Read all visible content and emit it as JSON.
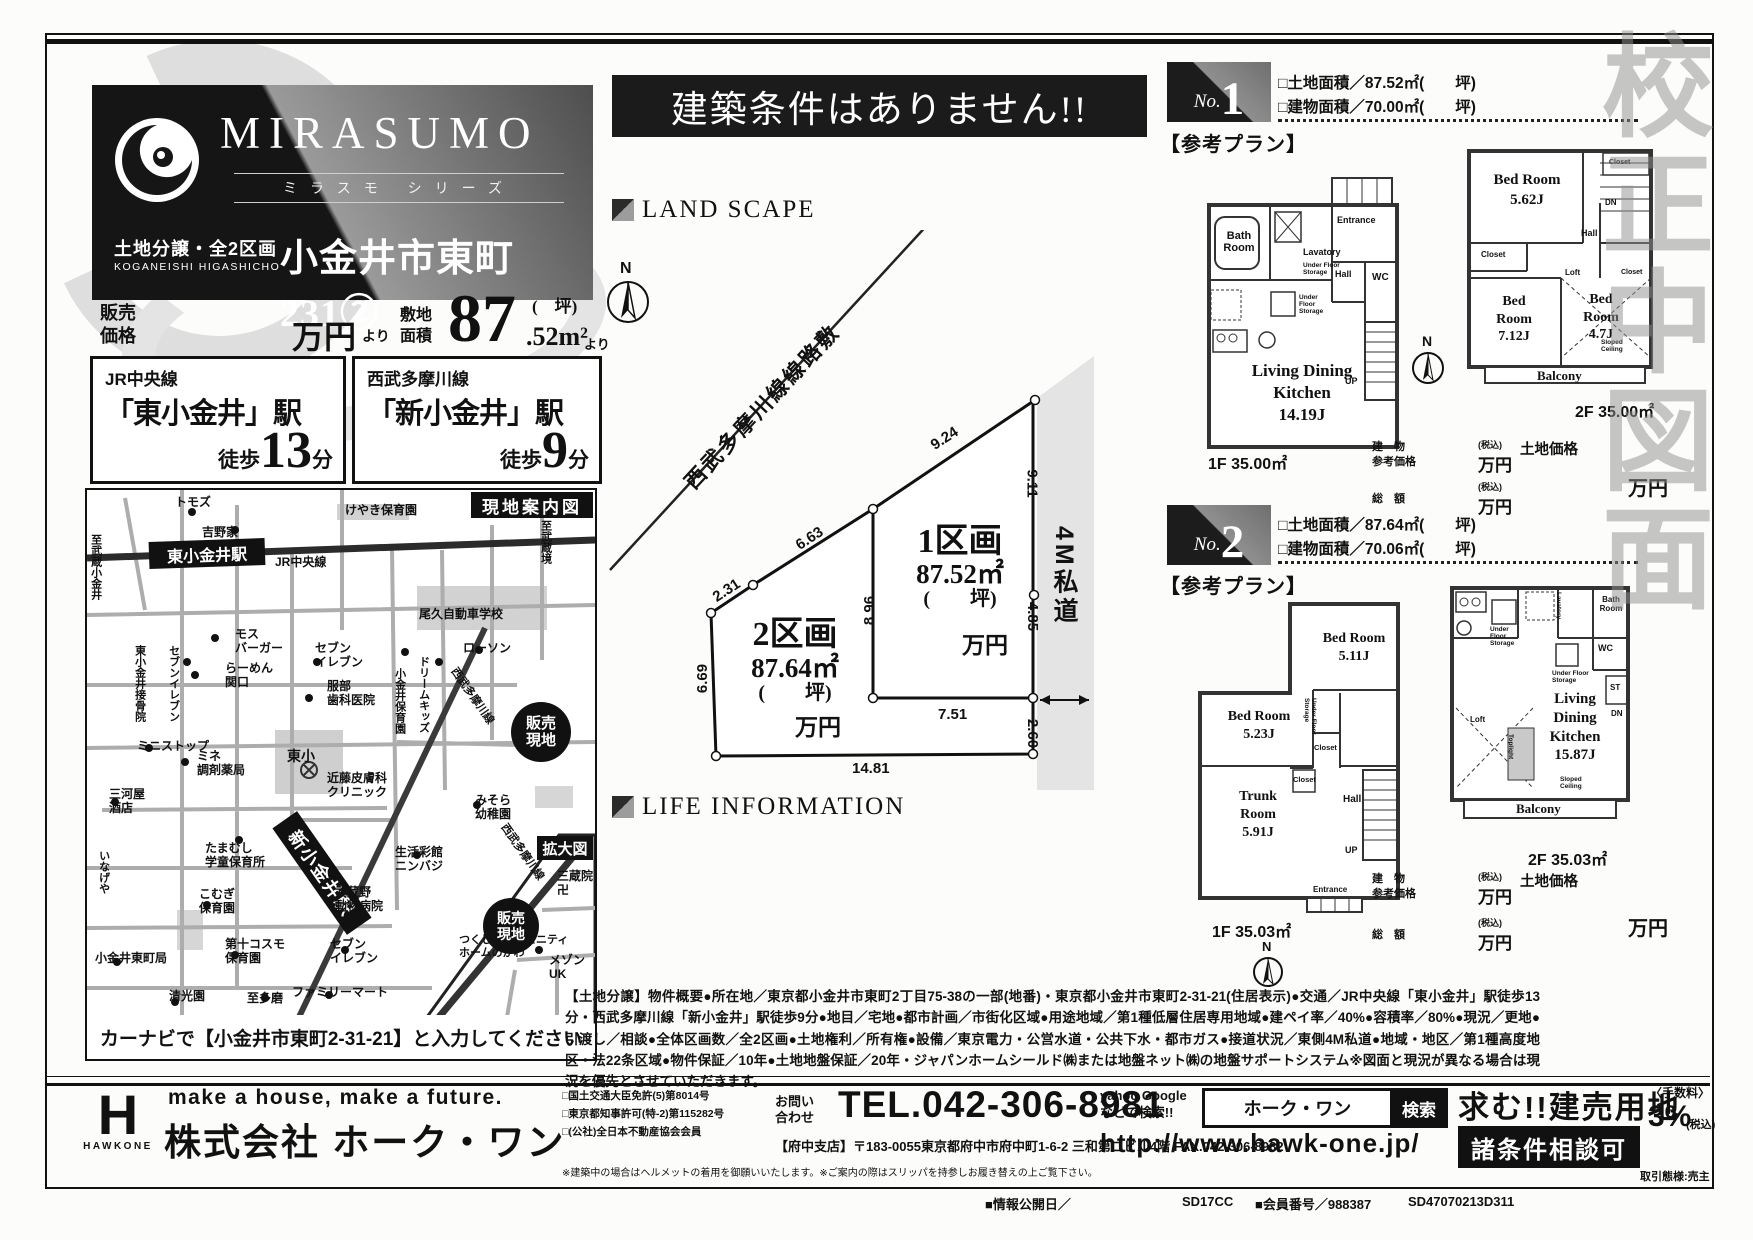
{
  "colors": {
    "ink": "#111111",
    "panel_dark": "#151515",
    "panel_gray": "#9a9a9a",
    "road_gray": "#adadad"
  },
  "watermark": "校正中図面",
  "brand": {
    "mirasumo": "MIRASUMO",
    "series": "ミラスモ シリーズ",
    "lot": "土地分譲・全2区画",
    "romaji": "KOGANEISHI HIGASHICHO",
    "name": "小金井市東町231②"
  },
  "price": {
    "label": "販売\n価格",
    "man": "万円",
    "yori": "より",
    "area_label": "敷地\n面積",
    "big": "87",
    "tsubo": "(　坪)",
    "dec": ".52m²",
    "yori2": "より"
  },
  "access": [
    {
      "line": "JR中央線",
      "station": "「東小金井」駅",
      "walk": "徒歩",
      "min": "13",
      "unit": "分"
    },
    {
      "line": "西武多摩川線",
      "station": "「新小金井」駅",
      "walk": "徒歩",
      "min": "9",
      "unit": "分"
    }
  ],
  "banner": "建築条件はありません!!",
  "sections": {
    "landscape": "LAND SCAPE",
    "lifeinfo": "LIFE INFORMATION"
  },
  "map": {
    "title": "現地案内図",
    "inset": "拡大図",
    "navi": "カーナビで【小金井市東町2-31-21】と入力してください",
    "labels": {
      "tomozu": "トモズ",
      "yoshinoya": "吉野家",
      "to_musashikoganei": "至武蔵小金井",
      "higashi_sta": "東小金井駅",
      "jr": "JR中央線",
      "keyaki": "けやき保育園",
      "to_musashisakai": "至武蔵境",
      "oku": "尾久自動車学校",
      "mos": "モス\nバーガー",
      "seven1": "セブンイレブン",
      "sekkotsu": "東小金井接骨院",
      "ramen": "らーめん\n関口",
      "seven2": "セブン\nイレブン",
      "hattori": "服部\n歯科医院",
      "koganei_hoiku": "小金井保育園",
      "dream": "ドリームキッズ",
      "lawson": "ローソン",
      "seibu": "西武多摩川線",
      "ministop": "ミニストップ",
      "mine": "ミネ\n調剤薬局",
      "tosho": "東小",
      "kondo": "近藤皮膚科\nクリニック",
      "misora": "みそら\n幼稚園",
      "mikawaya": "三河屋\n酒店",
      "hanbai": "販売\n現地",
      "tamamushi": "たまむし\n学童保育所",
      "seikatsu": "生活彩館\nニンバジ",
      "shin_sta": "新小金井駅",
      "musashino": "武蔵野\n動物病院",
      "inageya": "いなげや",
      "komugi": "こむぎ\n保育園",
      "cosmo": "第十コスモ\n保育園",
      "post": "小金井東町局",
      "seiko": "清光園",
      "tama": "至多磨",
      "family": "ファミリーマート",
      "seven3": "セブン\nイレブン",
      "sanzo": "三蔵院\n卍",
      "tsukushi": "つくし会コミュニティ\nホームのがわ",
      "maison": "メゾン\nUK",
      "hanbai2": "販売\n現地",
      "seibu2": "西武多摩川線"
    }
  },
  "plot": {
    "railway": "西武多摩川線線路敷",
    "north": "N",
    "road": "4M私道",
    "dims": {
      "a": "9.24",
      "b": "6.63",
      "c": "2.31",
      "d": "6.69",
      "e": "8.96",
      "f": "9.11",
      "g": "4.85",
      "h": "7.51",
      "j": "2.60",
      "k": "14.81"
    },
    "lot1": {
      "name": "1区画",
      "area": "87.52㎡",
      "tsubo": "(　　坪)",
      "price": "万円"
    },
    "lot2": {
      "name": "2区画",
      "area": "87.64㎡",
      "tsubo": "(　　坪)",
      "price": "万円"
    }
  },
  "plans": [
    {
      "no": "No.",
      "num": "1",
      "ref": "【参考プラン】",
      "land": "□土地面積／87.52㎡(　　坪)",
      "bldg": "□建物面積／70.00㎡(　　坪)",
      "f1_label": "1F 35.00㎡",
      "f2_label": "2F 35.00㎡",
      "f1rooms": {
        "bath": "Bath\nRoom",
        "lav": "Lavatory",
        "ufs": "Under Floor\nStorage",
        "ufs2": "Under\nFloor\nStorage",
        "ent": "Entrance",
        "hall": "Hall",
        "wc": "WC",
        "up": "UP",
        "ldk": "Living Dining\nKitchen\n14.19J"
      },
      "f2rooms": {
        "bed1": "Bed Room\n5.62J",
        "closet1": "Closet",
        "closet2": "Closet",
        "closet3": "Closet",
        "dn": "DN",
        "hall": "Hall",
        "loft": "Loft",
        "bed2": "Bed\nRoom\n7.12J",
        "bed3": "Bed\nRoom\n4.7J",
        "sloped": "Sloped\nCeiling",
        "balcony": "Balcony"
      },
      "prices": {
        "bldg_lbl": "建　物\n参考価格",
        "tax1": "(税込)",
        "man1": "万円",
        "total_lbl": "総　額",
        "tax2": "(税込)",
        "man2": "万円",
        "land_lbl": "土地価格",
        "man3": "万円"
      }
    },
    {
      "no": "No.",
      "num": "2",
      "ref": "【参考プラン】",
      "land": "□土地面積／87.64㎡(　　坪)",
      "bldg": "□建物面積／70.06㎡(　　坪)",
      "f1_label": "1F 35.03㎡",
      "f2_label": "2F 35.03㎡",
      "f1rooms": {
        "bed1": "Bed Room\n5.11J",
        "bed2": "Bed Room\n5.23J",
        "trunk": "Trunk\nRoom\n5.91J",
        "ufs": "Under Floor\nStorage",
        "closet1": "Closet",
        "closet2": "Closet",
        "hall": "Hall",
        "up": "UP",
        "ent": "Entrance"
      },
      "f2rooms": {
        "lav": "Lavatory",
        "bath": "Bath\nRoom",
        "ufs1": "Under\nFloor\nStorage",
        "ufs2": "Under Floor\nStorage",
        "wc": "WC",
        "dn": "DN",
        "st": "ST",
        "ldk": "Living\nDining\nKitchen\n15.87J",
        "loft": "Loft",
        "top": "Toplight",
        "sloped": "Sloped\nCeiling",
        "balcony": "Balcony"
      },
      "prices": {
        "bldg_lbl": "建　物\n参考価格",
        "tax1": "(税込)",
        "man1": "万円",
        "total_lbl": "総　額",
        "tax2": "(税込)",
        "man2": "万円",
        "land_lbl": "土地価格",
        "man3": "万円"
      }
    }
  ],
  "description": {
    "text": "【土地分譲】物件概要●所在地／東京都小金井市東町2丁目75-38の一部(地番)・東京都小金井市東町2-31-21(住居表示)●交通／JR中央線「東小金井」駅徒歩13分・西武多摩川線「新小金井」駅徒歩9分●地目／宅地●都市計画／市街化区域●用途地域／第1種低層住居専用地域●建ペイ率／40%●容積率／80%●現況／更地●引渡し／相談●全体区画数／全2区画●土地権利／所有権●設備／東京電力・公営水道・公共下水・都市ガス●接道状況／東側4M私道●地域・地区／第1種高度地区・法22条区域●物件保証／10年●土地地盤保証／20年・ジャパンホームシールド㈱または地盤ネット㈱の地盤サポートシステム※図面と現況が異なる場合は現況を優先とさせていただきます。"
  },
  "footer": {
    "logo_h": "H",
    "logo_name": "HAWKONE",
    "slogan": "make a house, make a future.",
    "company": "株式会社 ホーク・ワン",
    "licenses": "□国土交通大臣免許(5)第8014号\n□東京都知事許可(特-2)第115282号\n□(公社)全日本不動産協会会員",
    "contact": "お問い\n合わせ",
    "tel": "TEL.042-306-8981",
    "branch": "【府中支店】〒183-0055東京都府中市府中町1-6-2 三和第二ビル4階 FAX.042-306-8982",
    "note": "※建築中の場合はヘルメットの着用を御願いいたします。※ご案内の際はスリッパを持参しお履き替えの上ご覧下さい。",
    "yahoo": "yahoo Google\nなどで検索!!",
    "search_word": "ホーク・ワン",
    "search_btn": "検索",
    "url": "http://www.hawk-one.jp/",
    "wanted": "求む!!建売用地",
    "joken": "諸条件相談可",
    "fee_label": "〈手数料〉",
    "fee_value": "3%",
    "fee_tax": "(税込)",
    "torihiki": "取引態様:売主",
    "codes": {
      "info": "■情報公開日／",
      "c1": "SD17CC",
      "member": "■会員番号／988387",
      "c2": "SD47070213D311"
    }
  }
}
